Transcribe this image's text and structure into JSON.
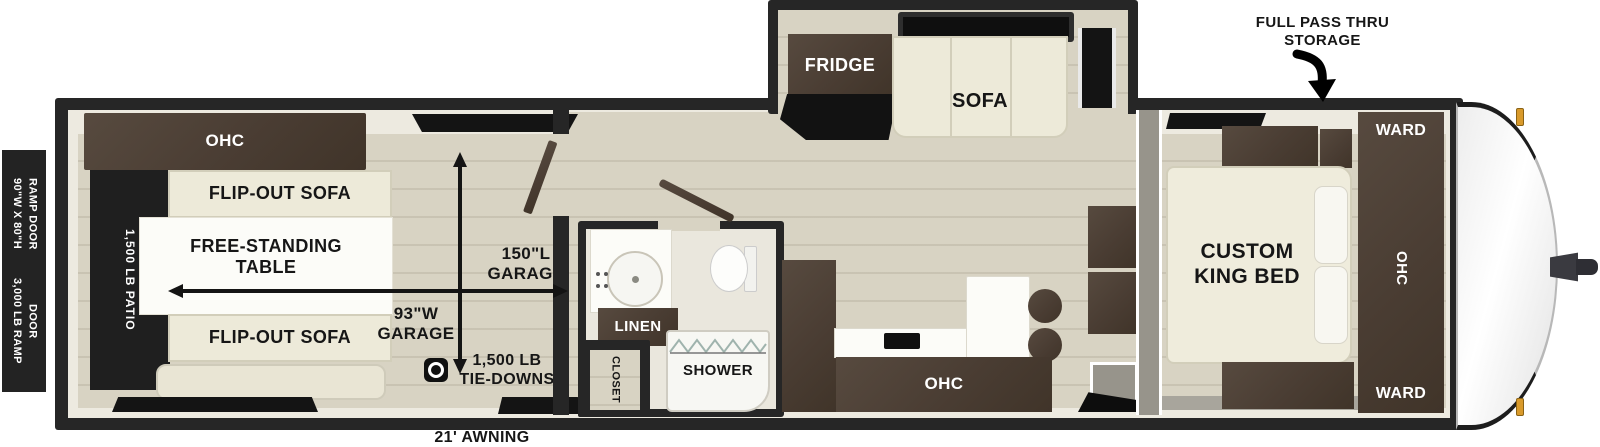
{
  "annotations": {
    "pass_thru_line1": "FULL PASS THRU",
    "pass_thru_line2": "STORAGE",
    "awning": "21' AWNING",
    "ramp_spec_line1": "90\"W X 80\"H",
    "ramp_spec_line2": "RAMP DOOR",
    "ramp_cap_line1": "3,000 LB RAMP",
    "ramp_cap_line2": "DOOR"
  },
  "garage": {
    "ohc": "OHC",
    "patio": "1,500 LB PATIO",
    "flip_sofa_top": "FLIP-OUT SOFA",
    "flip_sofa_bottom": "FLIP-OUT SOFA",
    "table_line1": "FREE-STANDING",
    "table_line2": "TABLE",
    "length_line1": "150\"L",
    "length_line2": "GARAGE",
    "width_line1": "93\"W",
    "width_line2": "GARAGE",
    "tiedowns_line1": "1,500 LB",
    "tiedowns_line2": "TIE-DOWNS"
  },
  "slideout": {
    "fridge": "FRIDGE",
    "sofa": "SOFA"
  },
  "bath": {
    "linen": "LINEN",
    "shower": "SHOWER",
    "closet": "CLOSET"
  },
  "kitchen": {
    "ohc": "OHC"
  },
  "bedroom": {
    "bed_line1": "CUSTOM",
    "bed_line2": "KING BED",
    "ward_top": "WARD",
    "ohc": "OHC",
    "ward_bottom": "WARD"
  },
  "icons": {
    "pass_thru_arrow": "curved-down-arrow",
    "tie_down": "anchor-ring",
    "garage_dimensions": "double-headed-arrows"
  },
  "colors": {
    "wall": "#262626",
    "cabinet": "#4a3d33",
    "floor": "#d8d3c3",
    "upholstery": "#edead9",
    "patio": "#1f1f1f",
    "marker_light": "#d99a2b"
  }
}
